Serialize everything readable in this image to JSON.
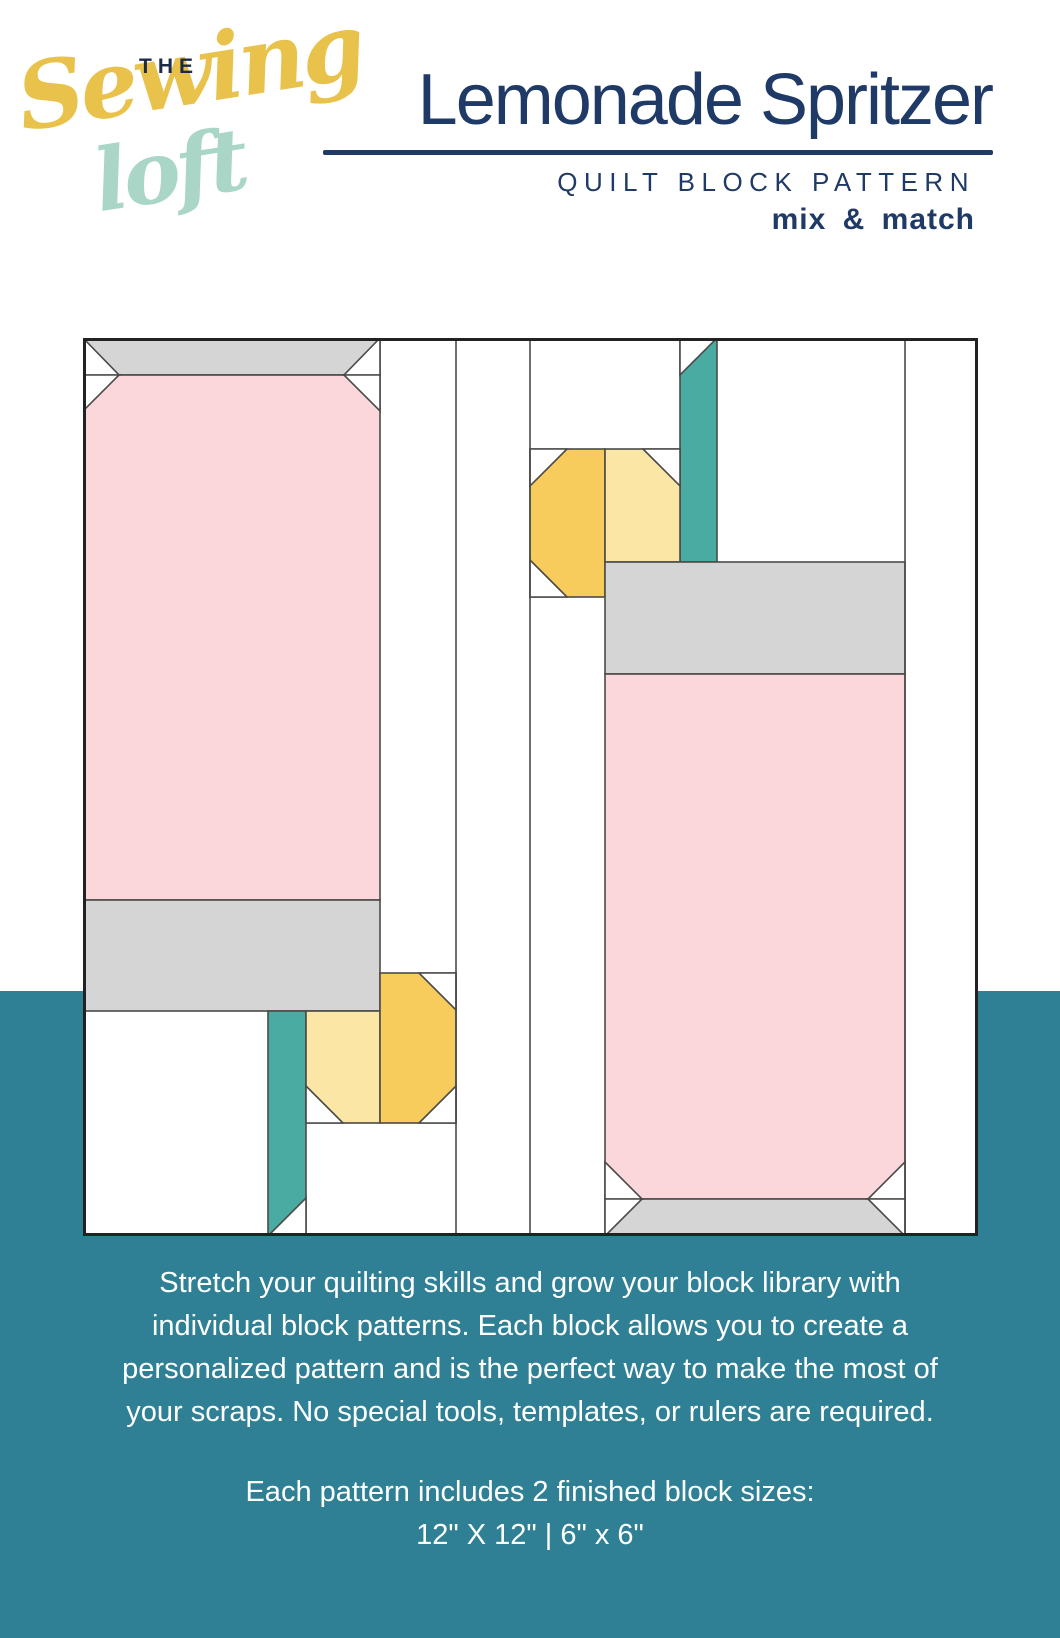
{
  "header": {
    "logo": {
      "the": "THE",
      "sewing": "Sewing",
      "loft": "loft"
    },
    "title": "Lemonade Spritzer",
    "subtitle": "QUILT BLOCK PATTERN",
    "tagline": "mix & match"
  },
  "footer": {
    "paragraph_lines": [
      "Stretch your quilting skills and grow your block library with",
      "individual block patterns. Each block allows you to create a",
      "personalized pattern and is the perfect way to make the most of",
      "your scraps. No special tools, templates, or rulers are required."
    ],
    "sizes_heading": "Each pattern includes 2 finished block sizes:",
    "sizes_value": "12\" X 12\" | 6\" x 6\""
  },
  "colors": {
    "navy": "#1f3a66",
    "logo_navy": "#1c2b48",
    "logo_yellow": "#e8c24b",
    "logo_mint": "#aad6c7",
    "band_teal": "#2f8095",
    "straw_teal": "#4aaba2",
    "pink": "#fbd7dc",
    "gray": "#d5d5d5",
    "dark_yellow": "#f8cb5d",
    "light_yellow": "#fbe6a6",
    "white": "#ffffff",
    "outline": "#4a4a48"
  },
  "diagram": {
    "label": "Lemonade Spritzer quilt block piecing diagram",
    "width": 895,
    "height": 898,
    "seam_width": 1.6,
    "border_width": 3,
    "patches": [
      {
        "name": "left-glass-rim",
        "x": 0,
        "y": 0,
        "w": 297,
        "h": 37,
        "fill": "gray"
      },
      {
        "name": "left-glass-body",
        "x": 0,
        "y": 37,
        "w": 297,
        "h": 525,
        "fill": "pink"
      },
      {
        "name": "left-glass-base",
        "x": 0,
        "y": 562,
        "w": 297,
        "h": 111,
        "fill": "gray"
      },
      {
        "name": "left-straw",
        "x": 185,
        "y": 673,
        "w": 38,
        "h": 225,
        "fill": "straw_teal"
      },
      {
        "name": "left-lemon-light-half",
        "x": 223,
        "y": 673,
        "w": 74,
        "h": 112,
        "fill": "light_yellow"
      },
      {
        "name": "left-lemon-dark-half",
        "x": 297,
        "y": 635,
        "w": 76,
        "h": 150,
        "fill": "dark_yellow"
      },
      {
        "name": "right-straw",
        "x": 597,
        "y": 0,
        "w": 37,
        "h": 224,
        "fill": "straw_teal"
      },
      {
        "name": "right-lemon-dark-half",
        "x": 447,
        "y": 111,
        "w": 75,
        "h": 148,
        "fill": "dark_yellow"
      },
      {
        "name": "right-lemon-light-half",
        "x": 522,
        "y": 111,
        "w": 75,
        "h": 113,
        "fill": "light_yellow"
      },
      {
        "name": "right-glass-base",
        "x": 522,
        "y": 224,
        "w": 300,
        "h": 112,
        "fill": "gray"
      },
      {
        "name": "right-glass-body",
        "x": 522,
        "y": 336,
        "w": 300,
        "h": 525,
        "fill": "pink"
      },
      {
        "name": "right-glass-rim",
        "x": 522,
        "y": 861,
        "w": 300,
        "h": 37,
        "fill": "gray"
      }
    ],
    "white_triangles": [
      {
        "name": "left-rim-corner-left",
        "points": "0,0 36,37 0,37"
      },
      {
        "name": "left-body-corner-left",
        "points": "0,37 36,37 0,73"
      },
      {
        "name": "left-rim-corner-right",
        "points": "297,0 261,37 297,37"
      },
      {
        "name": "left-body-corner-right",
        "points": "297,37 261,37 297,73"
      },
      {
        "name": "left-straw-corner",
        "points": "185,898 223,860 223,898"
      },
      {
        "name": "left-lemon-light-corner",
        "points": "223,748 260,785 223,785"
      },
      {
        "name": "left-lemon-dark-corner-top",
        "points": "336,635 373,635 373,672"
      },
      {
        "name": "left-lemon-dark-corner-bottom",
        "points": "373,748 373,785 336,785"
      },
      {
        "name": "right-straw-corner",
        "points": "597,0 634,0 597,37"
      },
      {
        "name": "right-lemon-dark-corner-top",
        "points": "447,111 484,111 447,148"
      },
      {
        "name": "right-lemon-dark-corner-bottom",
        "points": "447,222 484,259 447,259"
      },
      {
        "name": "right-lemon-light-corner",
        "points": "560,111 597,111 597,148"
      },
      {
        "name": "right-body-corner-left",
        "points": "522,824 559,861 522,861"
      },
      {
        "name": "right-body-corner-right",
        "points": "822,824 785,861 822,861"
      },
      {
        "name": "right-rim-corner-left",
        "points": "522,861 559,861 522,898"
      },
      {
        "name": "right-rim-corner-right",
        "points": "822,861 785,861 822,898"
      }
    ],
    "seam_lines": [
      [
        373,
        0,
        373,
        898
      ],
      [
        447,
        0,
        447,
        898
      ],
      [
        822,
        0,
        822,
        898
      ]
    ]
  }
}
